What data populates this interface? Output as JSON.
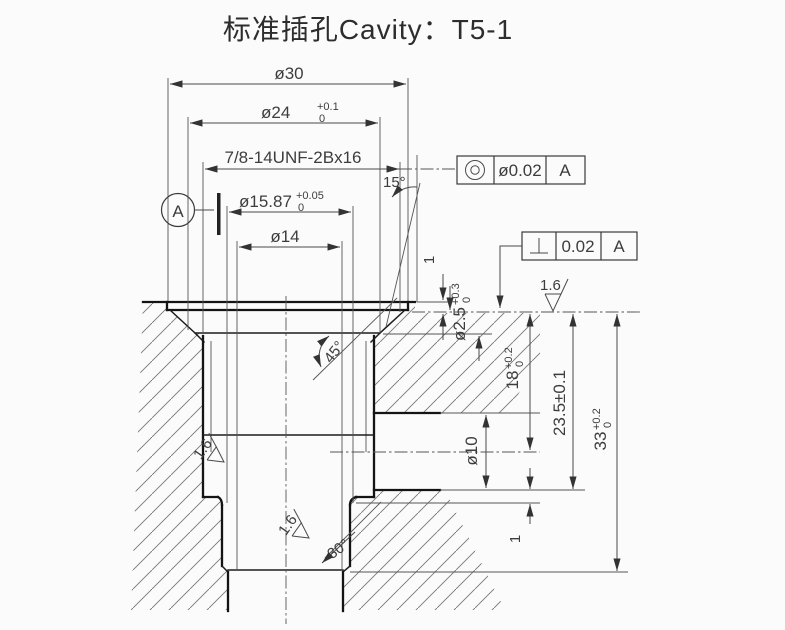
{
  "title": "标准插孔Cavity：T5-1",
  "dims": {
    "d30": {
      "label": "ø30"
    },
    "d24": {
      "main": "ø24",
      "sup": "+0.1",
      "sub": "0"
    },
    "thread": {
      "label": "7/8-14UNF-2Bx16"
    },
    "d1587": {
      "main": "ø15.87",
      "sup": "+0.05",
      "sub": "0"
    },
    "d14": {
      "label": "ø14"
    },
    "angle15": {
      "label": "15°"
    },
    "angle45": {
      "label": "45°"
    },
    "angle30": {
      "label": "30°"
    },
    "step1_top": {
      "label": "1"
    },
    "step1_bottom": {
      "label": "1"
    },
    "d25": {
      "main": "ø2.5",
      "sup": "+0.3",
      "sub": "0"
    },
    "d10": {
      "label": "ø10"
    },
    "depth18": {
      "main": "18",
      "sup": "+0.2",
      "sub": "0"
    },
    "depth235": {
      "label": "23.5±0.1"
    },
    "depth33": {
      "main": "33",
      "sup": "+0.2",
      "sub": "0"
    }
  },
  "roughness": {
    "top": "1.6",
    "mid": "1.6",
    "bottom": "1.6"
  },
  "fcf": {
    "concentricity": {
      "symbol": "concentricity-icon",
      "tolerance": "ø0.02",
      "datum": "A"
    },
    "perpendicularity": {
      "symbol": "perpendicularity-icon",
      "tolerance": "0.02",
      "datum": "A"
    }
  },
  "datum": {
    "label": "A"
  },
  "colors": {
    "line": "#141414",
    "dim": "#4a4a4a",
    "background": "#fbfbfb"
  }
}
